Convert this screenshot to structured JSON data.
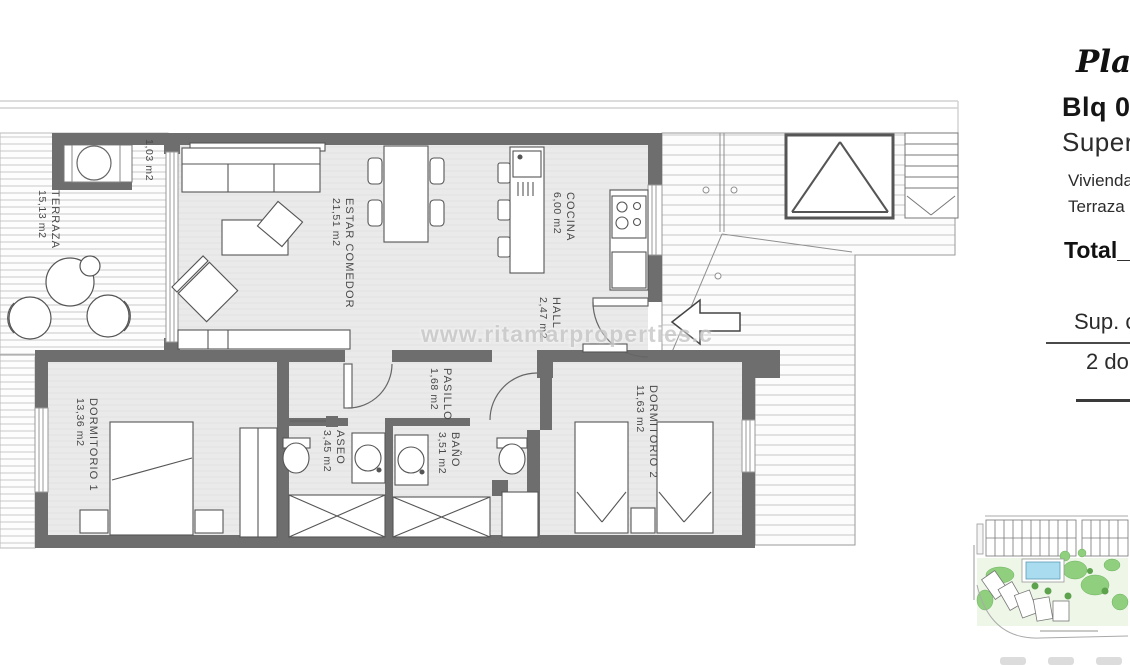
{
  "info_panel": {
    "planta": "Planta",
    "block": "Blq 03",
    "superficie": "Superfi",
    "vivienda": "Vivienda",
    "terraza": "Terraza",
    "total": "Total_",
    "sup_construida": "Sup. co",
    "bedrooms": "2 do"
  },
  "watermark": "www.ritamarproperties.c",
  "rooms": {
    "terraza": {
      "name": "TERRAZA",
      "area": "15,13 m2"
    },
    "storage": {
      "area": "1,03 m2"
    },
    "estar_comedor": {
      "name": "ESTAR COMEDOR",
      "area": "21,51 m2"
    },
    "cocina": {
      "name": "COCINA",
      "area": "6,00 m2"
    },
    "hall": {
      "name": "HALL",
      "area": "2,47 m2"
    },
    "pasillo": {
      "name": "PASILLO",
      "area": "1,68 m2"
    },
    "aseo": {
      "name": "ASEO",
      "area": "3,45 m2"
    },
    "bano": {
      "name": "BAÑO",
      "area": "3,51 m2"
    },
    "dormitorio1": {
      "name": "DORMITORIO 1",
      "area": "13,36 m2"
    },
    "dormitorio2": {
      "name": "DORMITORIO 2",
      "area": "11,63 m2"
    }
  },
  "colors": {
    "wall": "#6e6e6e",
    "floor": "#eaeaea",
    "label": "#4a4a4a",
    "pool": "#aadcf0",
    "green": "#8fcf7e"
  }
}
